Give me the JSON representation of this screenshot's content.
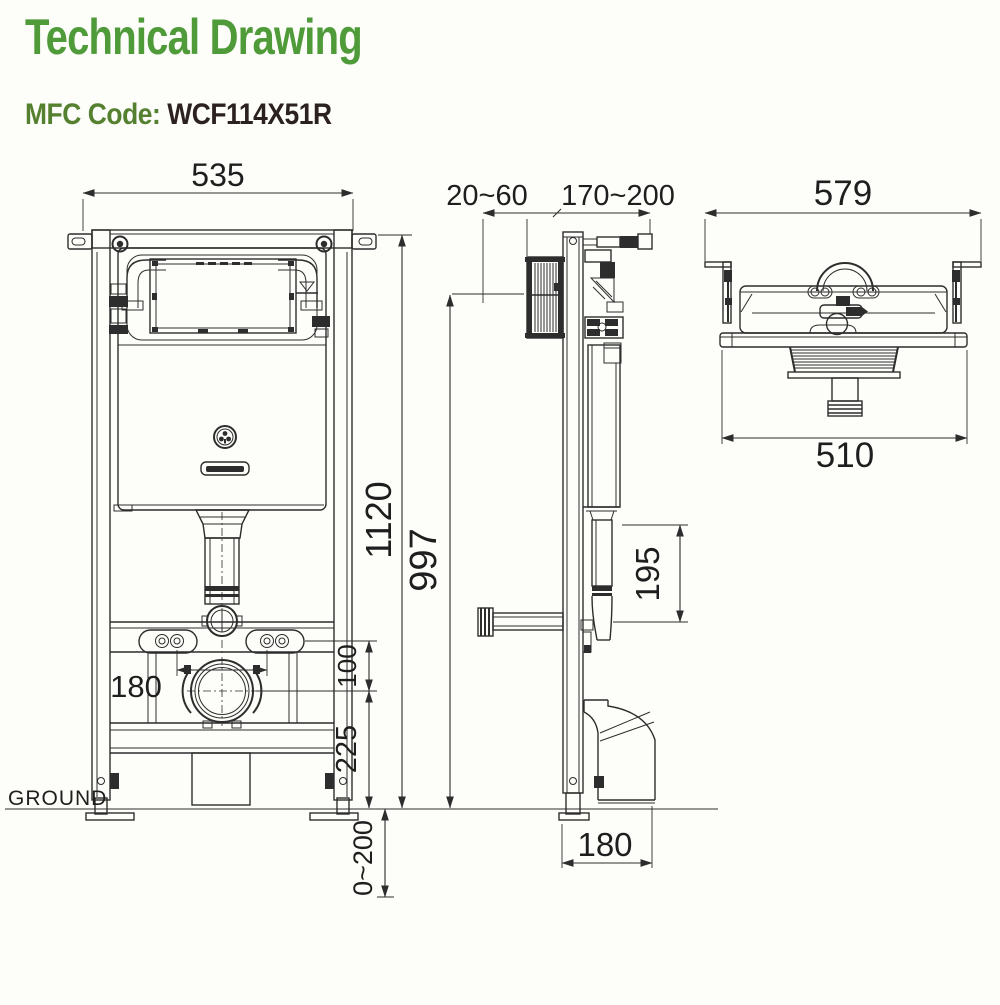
{
  "header": {
    "title": "Technical Drawing",
    "mfc_label": "MFC Code:",
    "mfc_code": "WCF114X51R"
  },
  "colors": {
    "title_green": "#4f9b3a",
    "mfc_green": "#55802f",
    "code_dark": "#2b2220",
    "line": "#2d2d2d"
  },
  "front_view": {
    "ground_label": "GROUND",
    "dim_frame_width": "535",
    "dim_frame_height": "1120",
    "dim_bolt_spacing": "180",
    "dim_bolt_to_outlet": "100",
    "dim_outlet_height": "225",
    "dim_leg_adjust": "0~200"
  },
  "side_view": {
    "dim_wall_clearance": "20~60",
    "dim_install_depth": "170~200",
    "dim_flush_panel_height": "997",
    "dim_bend_height": "195",
    "dim_outlet_depth": "180"
  },
  "top_view": {
    "dim_bracket_width": "579",
    "dim_body_width": "510"
  }
}
